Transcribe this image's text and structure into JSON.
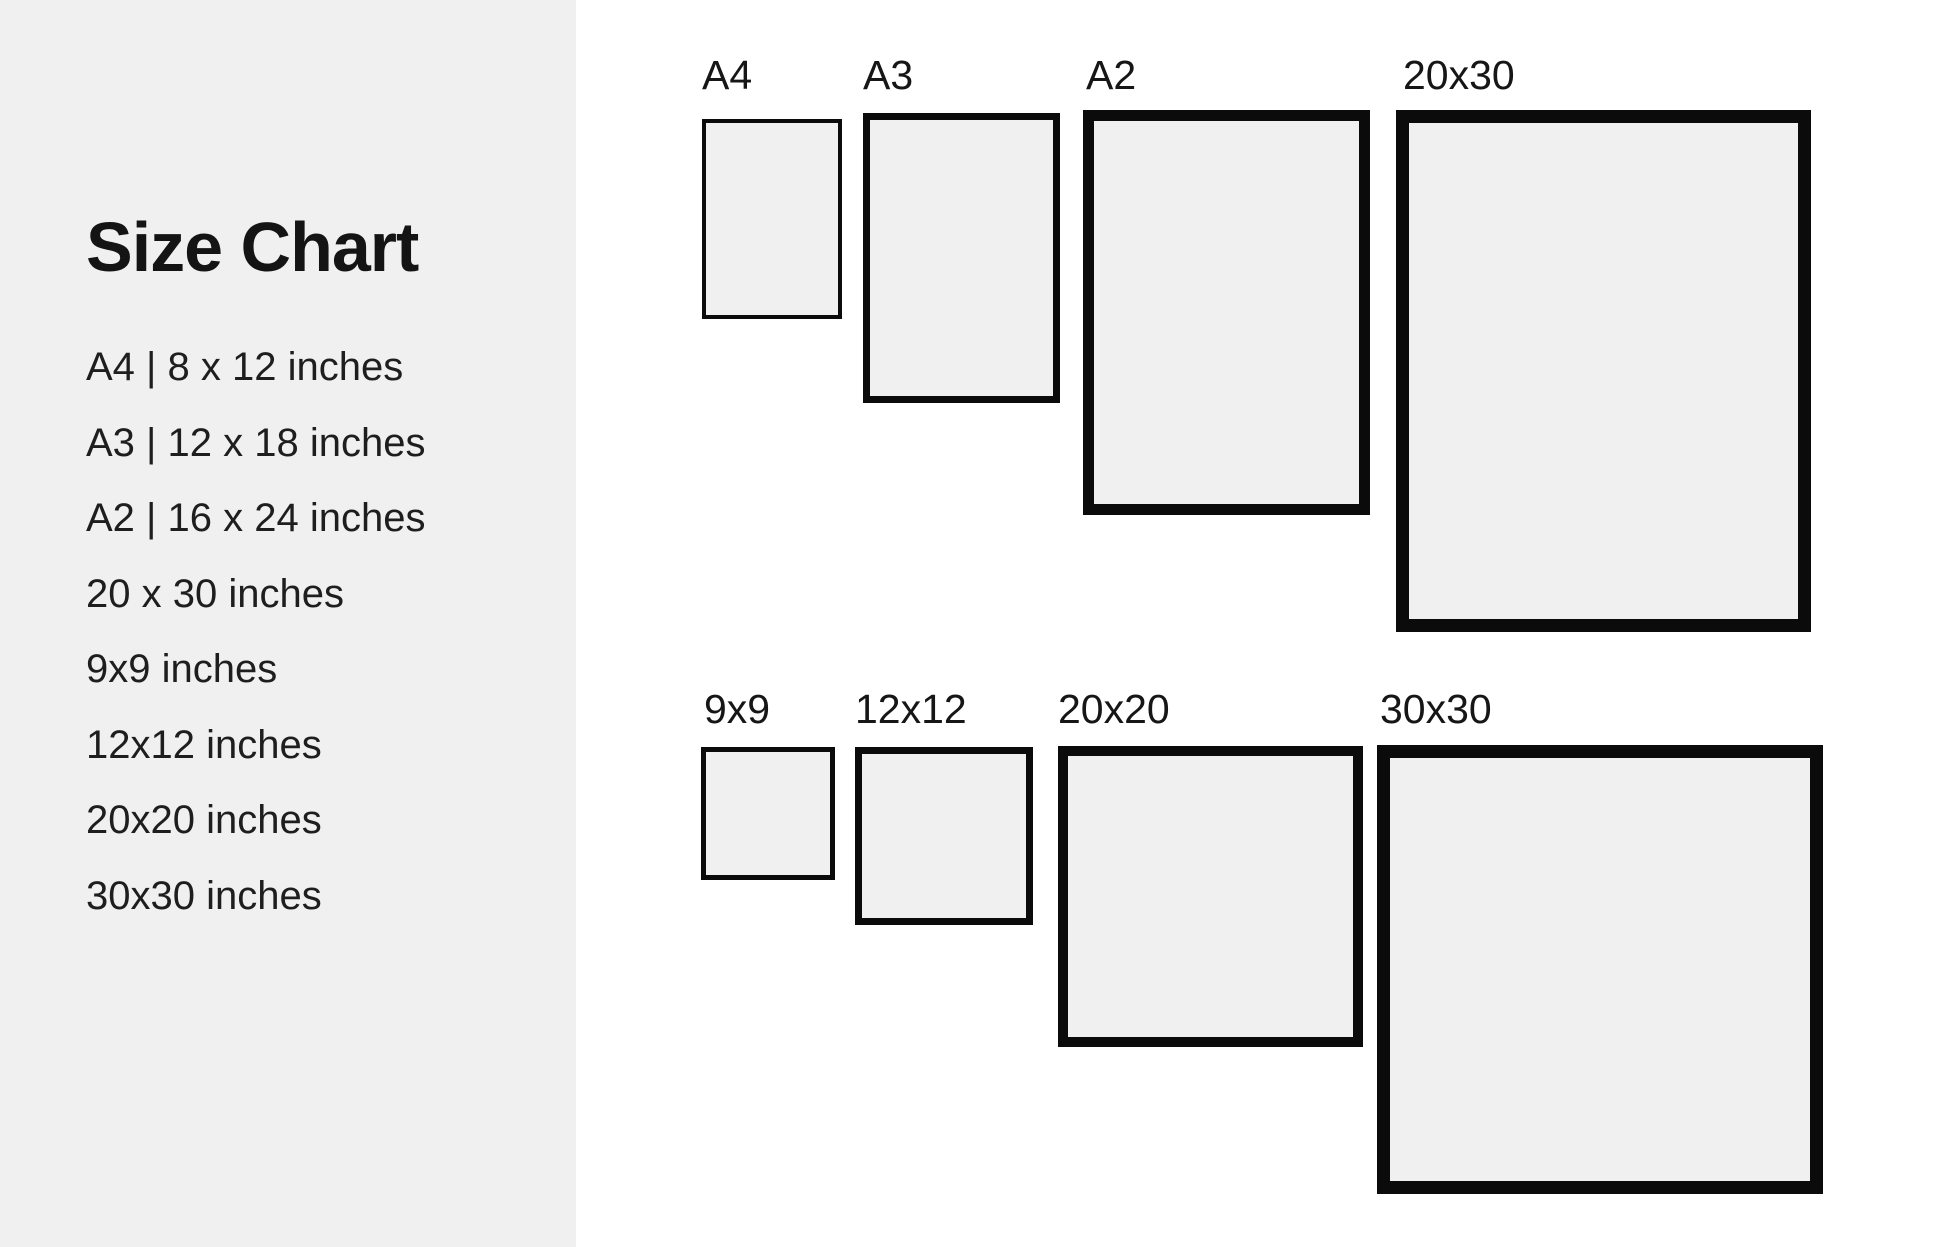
{
  "page": {
    "background": "#ffffff"
  },
  "sidebar": {
    "background": "#f0f0f0",
    "title": "Size Chart",
    "items": [
      "A4 | 8 x 12 inches",
      "A3 | 12 x 18 inches",
      "A2 | 16 x 24 inches",
      "20 x 30 inches",
      "9x9 inches",
      "12x12 inches",
      "20x20 inches",
      "30x30 inches"
    ]
  },
  "diagram": {
    "fill_color": "#f0f0f0",
    "border_color": "#0b0b0b",
    "label_color": "#161616",
    "rows": [
      {
        "name": "portrait-sizes",
        "label_top": 55,
        "posters": [
          {
            "label": "A4",
            "x": 702,
            "y": 119,
            "w": 140,
            "h": 200,
            "border": 4,
            "label_x": 702
          },
          {
            "label": "A3",
            "x": 863,
            "y": 113,
            "w": 197,
            "h": 290,
            "border": 7,
            "label_x": 863
          },
          {
            "label": "A2",
            "x": 1083,
            "y": 110,
            "w": 287,
            "h": 405,
            "border": 11,
            "label_x": 1086
          },
          {
            "label": "20x30",
            "x": 1396,
            "y": 110,
            "w": 415,
            "h": 522,
            "border": 13,
            "label_x": 1403
          }
        ]
      },
      {
        "name": "square-sizes",
        "label_top": 689,
        "posters": [
          {
            "label": "9x9",
            "x": 701,
            "y": 747,
            "w": 134,
            "h": 133,
            "border": 5,
            "label_x": 704
          },
          {
            "label": "12x12",
            "x": 855,
            "y": 747,
            "w": 178,
            "h": 178,
            "border": 7,
            "label_x": 855
          },
          {
            "label": "20x20",
            "x": 1058,
            "y": 746,
            "w": 305,
            "h": 301,
            "border": 10,
            "label_x": 1058
          },
          {
            "label": "30x30",
            "x": 1377,
            "y": 745,
            "w": 446,
            "h": 449,
            "border": 13,
            "label_x": 1380
          }
        ]
      }
    ]
  }
}
